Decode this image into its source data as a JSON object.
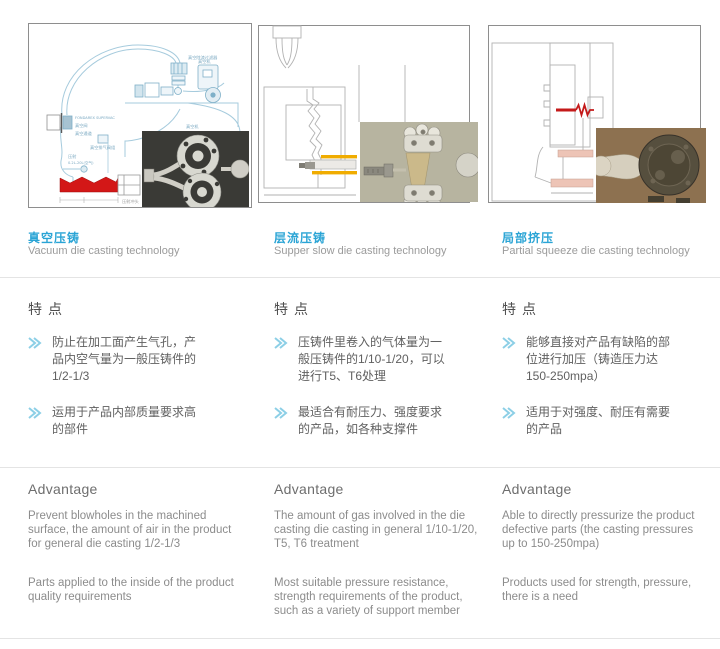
{
  "accent_color": "#2aa4d5",
  "columns": [
    {
      "title_zh": "真空压铸",
      "title_en": "Vacuum die casting technology",
      "features_heading": "特点",
      "features": [
        "防止在加工面产生气孔，产品内空气量为一般压铸件的1/2-1/3",
        "运用于产品内部质量要求高的部件"
      ],
      "advantage_heading": "Advantage",
      "advantages": [
        "Prevent blowholes in the machined surface, the amount of air in the product for general die casting 1/2-1/3",
        "Parts applied to the inside of the product quality requirements"
      ],
      "diagram_labels": {
        "filter": "真空除渣过滤器",
        "machine": "真空机",
        "brand": "FONDAREX SUPERVAC",
        "valve": "真空阀",
        "channel": "真空通道",
        "valve_group": "真空排气阀组",
        "shot1": "压射",
        "shot2": "0.2L-20L(空气)",
        "plunger": "压射冲头",
        "inset": "真空机"
      }
    },
    {
      "title_zh": "层流压铸",
      "title_en": "Supper slow die casting technology",
      "features_heading": "特点",
      "features": [
        "压铸件里卷入的气体量为一般压铸件的1/10-1/20，可以进行T5、T6处理",
        "最适合有耐压力、强度要求的产品，如各种支撑件"
      ],
      "advantage_heading": "Advantage",
      "advantages": [
        "The amount of gas involved in the die casting die casting in general 1/10-1/20, T5, T6 treatment",
        "Most suitable pressure resistance, strength requirements of the product, such as a variety of support member"
      ]
    },
    {
      "title_zh": "局部挤压",
      "title_en": "Partial squeeze die casting technology",
      "features_heading": "特点",
      "features": [
        "能够直接对产品有缺陷的部位进行加压（铸造压力达150-250mpa）",
        "适用于对强度、耐压有需要的产品"
      ],
      "advantage_heading": "Advantage",
      "advantages": [
        "Able to directly pressurize the product defective parts (the casting pressures up to 150-250mpa)",
        "Products used for strength, pressure, there is a need"
      ]
    }
  ]
}
